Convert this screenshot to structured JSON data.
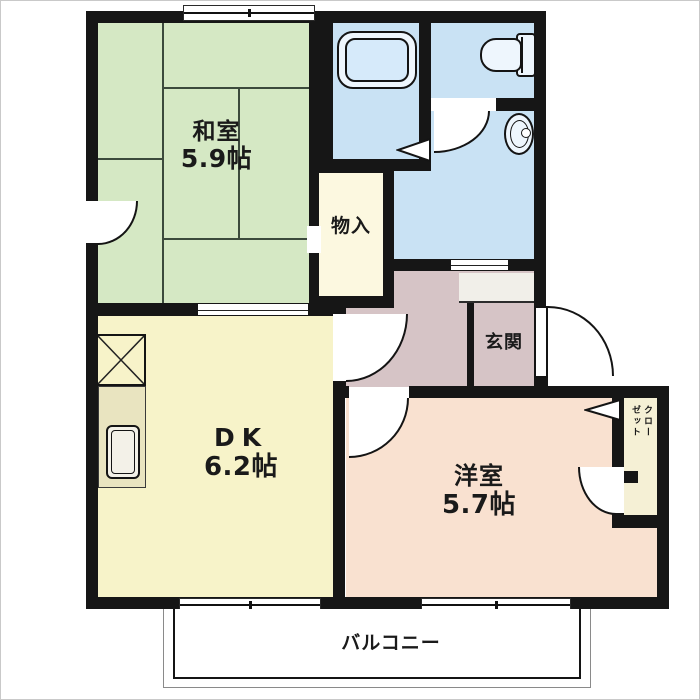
{
  "plan": {
    "rooms": {
      "washitsu": {
        "label": "和室",
        "size": "5.9帖",
        "color": "#d5e8c4"
      },
      "monoire": {
        "label": "物入",
        "color": "#fcf8e0"
      },
      "dk": {
        "label": "DK",
        "size": "6.2帖",
        "color": "#f7f3c9"
      },
      "yoshitsu": {
        "label": "洋室",
        "size": "5.7帖",
        "color": "#f9e1d0"
      },
      "genkan": {
        "label": "玄関",
        "color": "#d6c4c6"
      },
      "hall": {
        "color": "#d6c4c6"
      },
      "bath": {
        "color": "#c9e2f4"
      },
      "toilet": {
        "color": "#c9e2f4"
      },
      "washroom": {
        "color": "#c9e2f4"
      },
      "closet": {
        "label": "クローゼット",
        "color": "#f5f0d5"
      },
      "step": {
        "color": "#f1efe9"
      },
      "balcony": {
        "label": "バルコニー",
        "color": "#ffffff"
      }
    },
    "palette": {
      "wall": "#161616",
      "tatami_line": "#3c4a3c",
      "counter": "#e9e4c0",
      "fixture_fill": "#eef6fd",
      "bathtub_inner": "#d6eafa",
      "frame": "#c9c9c9"
    },
    "icons": [
      "bathtub-icon",
      "toilet-icon",
      "washbasin-icon",
      "kitchen-sink-icon",
      "refrigerator-space-icon",
      "door-swing-icon",
      "sliding-window-icon"
    ]
  }
}
